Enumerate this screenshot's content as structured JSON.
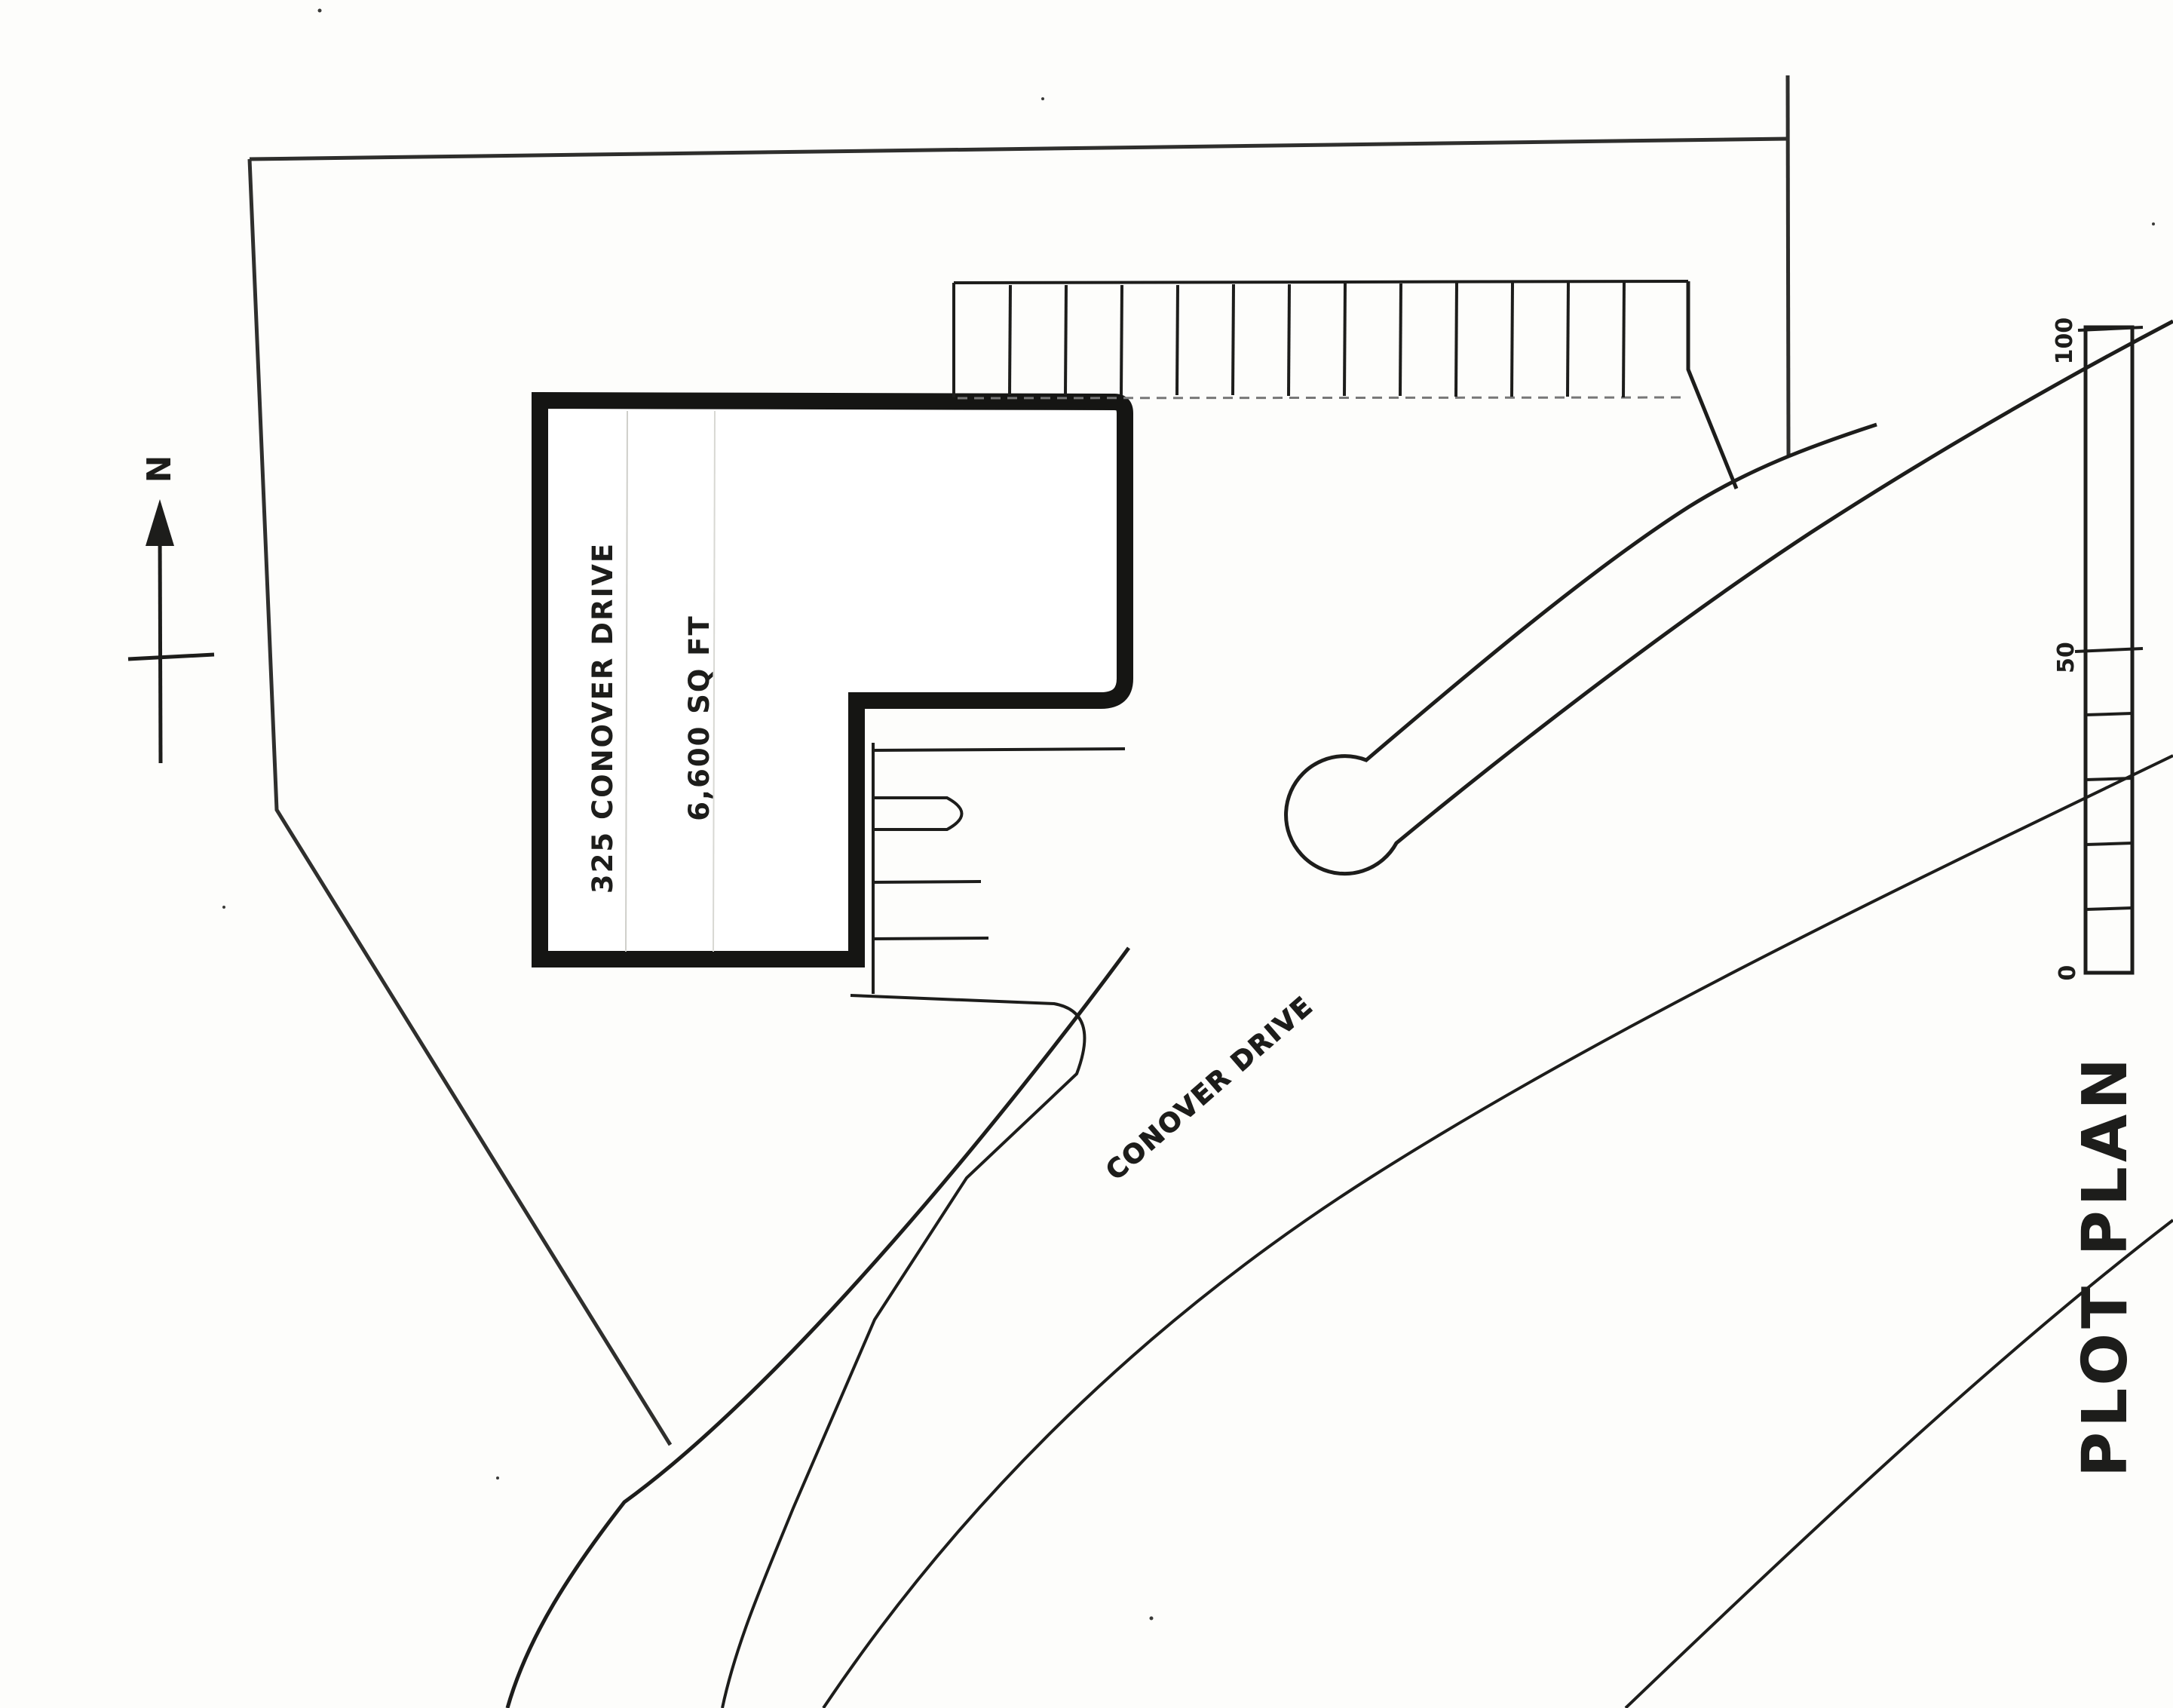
{
  "title": "PLOT PLAN",
  "north": {
    "label": "N"
  },
  "building": {
    "address": "325 CONOVER DRIVE",
    "area": "6,600 SQ FT"
  },
  "road": {
    "name": "CONOVER DRIVE"
  },
  "scale_bar": {
    "labels": [
      "100",
      "50",
      "0"
    ]
  },
  "colors": {
    "ink": "#1d1d1b",
    "paper": "#fdfdfb",
    "faint": "#777777"
  }
}
